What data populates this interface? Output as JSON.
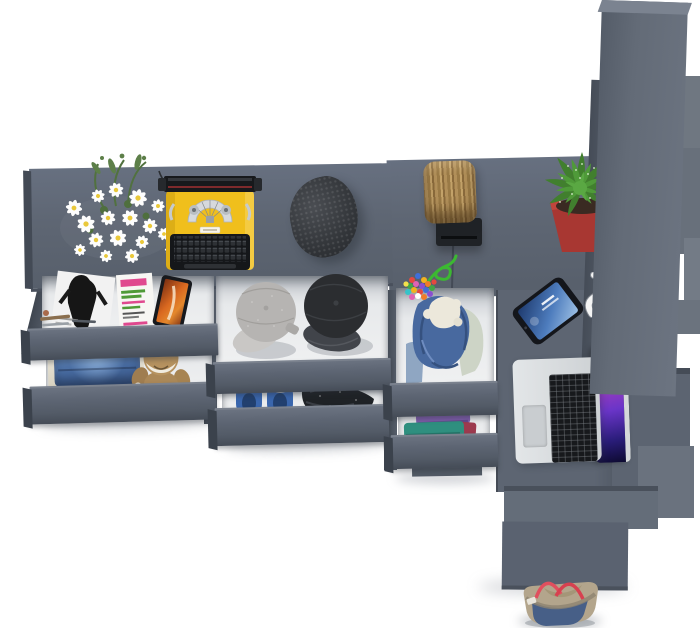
{
  "scene": {
    "description": "Top-down 3D render of a dark gray modular wardrobe and desk system with open drawers, shown on a white background with lifestyle props",
    "view": "top-down product render",
    "background": "#ffffff",
    "text_visible": "none"
  },
  "palette": {
    "furniture_gray": "#5e6672",
    "furniture_gray_light": "#6d7583",
    "furniture_gray_dark": "#454c57",
    "drawer_interior": "#e9ebed",
    "typewriter_yellow": "#f0bf1c",
    "planter_red": "#a83732",
    "cactus_green": "#4f9a39",
    "cord_green": "#3cb832",
    "denim_blue": "#48699f",
    "shoe_blue": "#3a66ad",
    "strap_red": "#e04f5e",
    "teddy_brown": "#b6925f",
    "beanie_charcoal": "#34373b",
    "stool_wood": "#b18f59",
    "laptop_silver": "#d3d6d9",
    "screen_magenta": "#c93f8e",
    "phone_screen_blue": "#4d7cbd",
    "magazine_pink": "#e0498f",
    "magazine_green": "#4f9a37",
    "media_orange": "#e4882c"
  },
  "furniture": {
    "sections": [
      {
        "id": "main-desk",
        "label": "long desk top with props"
      },
      {
        "id": "right-surface",
        "label": "raised return surface"
      },
      {
        "id": "laptop-column",
        "label": "desk column holding laptop"
      },
      {
        "id": "wardrobe-panel",
        "label": "tall wardrobe side panel with stepped shelves"
      },
      {
        "id": "stair-blocks",
        "label": "stepped base descending to floor"
      }
    ],
    "drawer_stacks": [
      {
        "id": "left-stack",
        "contents": [
          "magazines and phone",
          "folded jeans",
          "teddy bear"
        ]
      },
      {
        "id": "middle-stack",
        "contents": [
          "gray cap",
          "black cap",
          "blue slip-on shoes",
          "folded dark jacket"
        ]
      },
      {
        "id": "column-stack",
        "contents": [
          "denim hoodie with fleece lining",
          "stack of folded colorful clothes"
        ]
      }
    ]
  },
  "objects": [
    {
      "id": "flower-bouquet",
      "label": "white daisy bouquet"
    },
    {
      "id": "typewriter",
      "label": "yellow vintage typewriter with black keys"
    },
    {
      "id": "beanie",
      "label": "charcoal knit beanie"
    },
    {
      "id": "log-stool",
      "label": "wooden log stool"
    },
    {
      "id": "stool-bracket",
      "label": "black mounting bracket"
    },
    {
      "id": "bead-keychain",
      "label": "multicolor bead charm on green cord"
    },
    {
      "id": "cactus-planter",
      "label": "green succulent in red planter"
    },
    {
      "id": "smartphone",
      "label": "smartphone with blue lock screen"
    },
    {
      "id": "white-hook",
      "label": "white hook on wardrobe panel"
    },
    {
      "id": "laptop",
      "label": "open silver laptop with purple wallpaper"
    },
    {
      "id": "fashion-magazine",
      "label": "black and white fashion magazine"
    },
    {
      "id": "text-magazine",
      "label": "magazine with pink and green cover text"
    },
    {
      "id": "media-phone",
      "label": "phone showing orange artwork"
    },
    {
      "id": "stationery",
      "label": "pens and cosmetics"
    },
    {
      "id": "folded-jeans",
      "label": "folded blue jeans on mat"
    },
    {
      "id": "teddy-bear",
      "label": "brown teddy bear"
    },
    {
      "id": "gray-cap",
      "label": "gray cadet cap"
    },
    {
      "id": "black-cap",
      "label": "black cadet cap"
    },
    {
      "id": "blue-shoes",
      "label": "pair of blue slip-on shoes"
    },
    {
      "id": "folded-jacket",
      "label": "folded dark jacket with blue lining"
    },
    {
      "id": "denim-hoodie",
      "label": "denim hoodie with fleece lining"
    },
    {
      "id": "folded-clothes",
      "label": "folded purple, teal and red clothes"
    },
    {
      "id": "tote-bag",
      "label": "denim and canvas tote with red straps"
    }
  ]
}
